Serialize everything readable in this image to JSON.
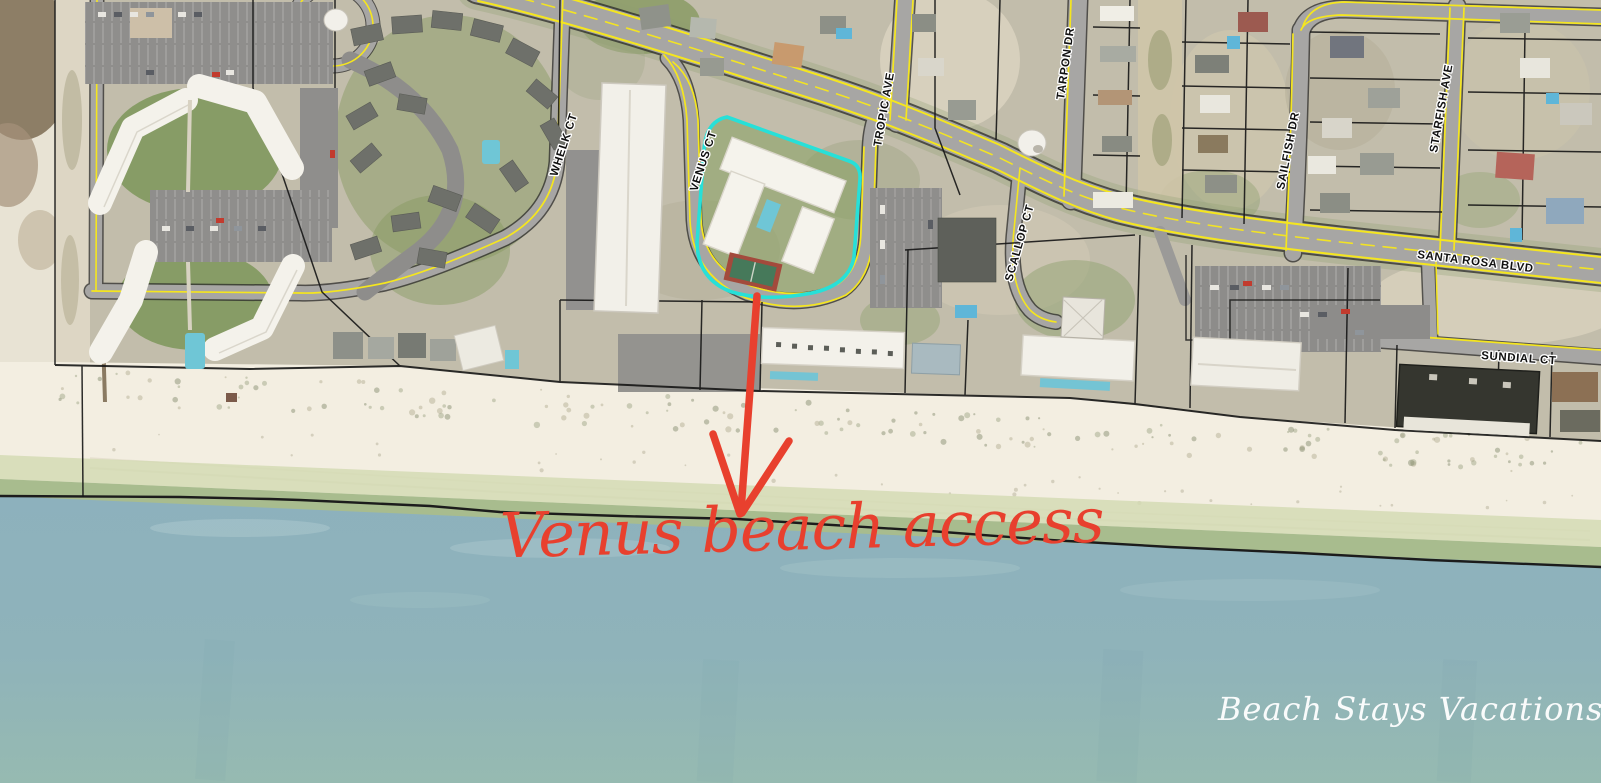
{
  "map": {
    "streets": {
      "whelk": "WHELK CT",
      "venus": "VENUS CT",
      "tropic": "TROPIC AVE",
      "scallop": "SCALLOP CT",
      "tarpon": "TARPON DR",
      "sailfish": "SAILFISH DR",
      "starfish": "STARFISH AVE",
      "santa_rosa": "SANTA ROSA BLVD",
      "sundial": "SUNDIAL CT"
    },
    "annotation": {
      "text": "Venus beach access",
      "color": "#e8402e"
    },
    "watermark": {
      "text": "Beach Stays Vacations",
      "color": "#ffffff"
    },
    "highlight": {
      "color": "#27e0d8"
    },
    "arrow": {
      "color": "#e8402e"
    },
    "colors": {
      "water": "#8db1bd",
      "shallow_water": "#a8bc8e",
      "sand": "#f3eee1",
      "road": "#a7a6a4",
      "road_edge_line": "#f5e61e",
      "parcel_line": "#161616"
    }
  }
}
